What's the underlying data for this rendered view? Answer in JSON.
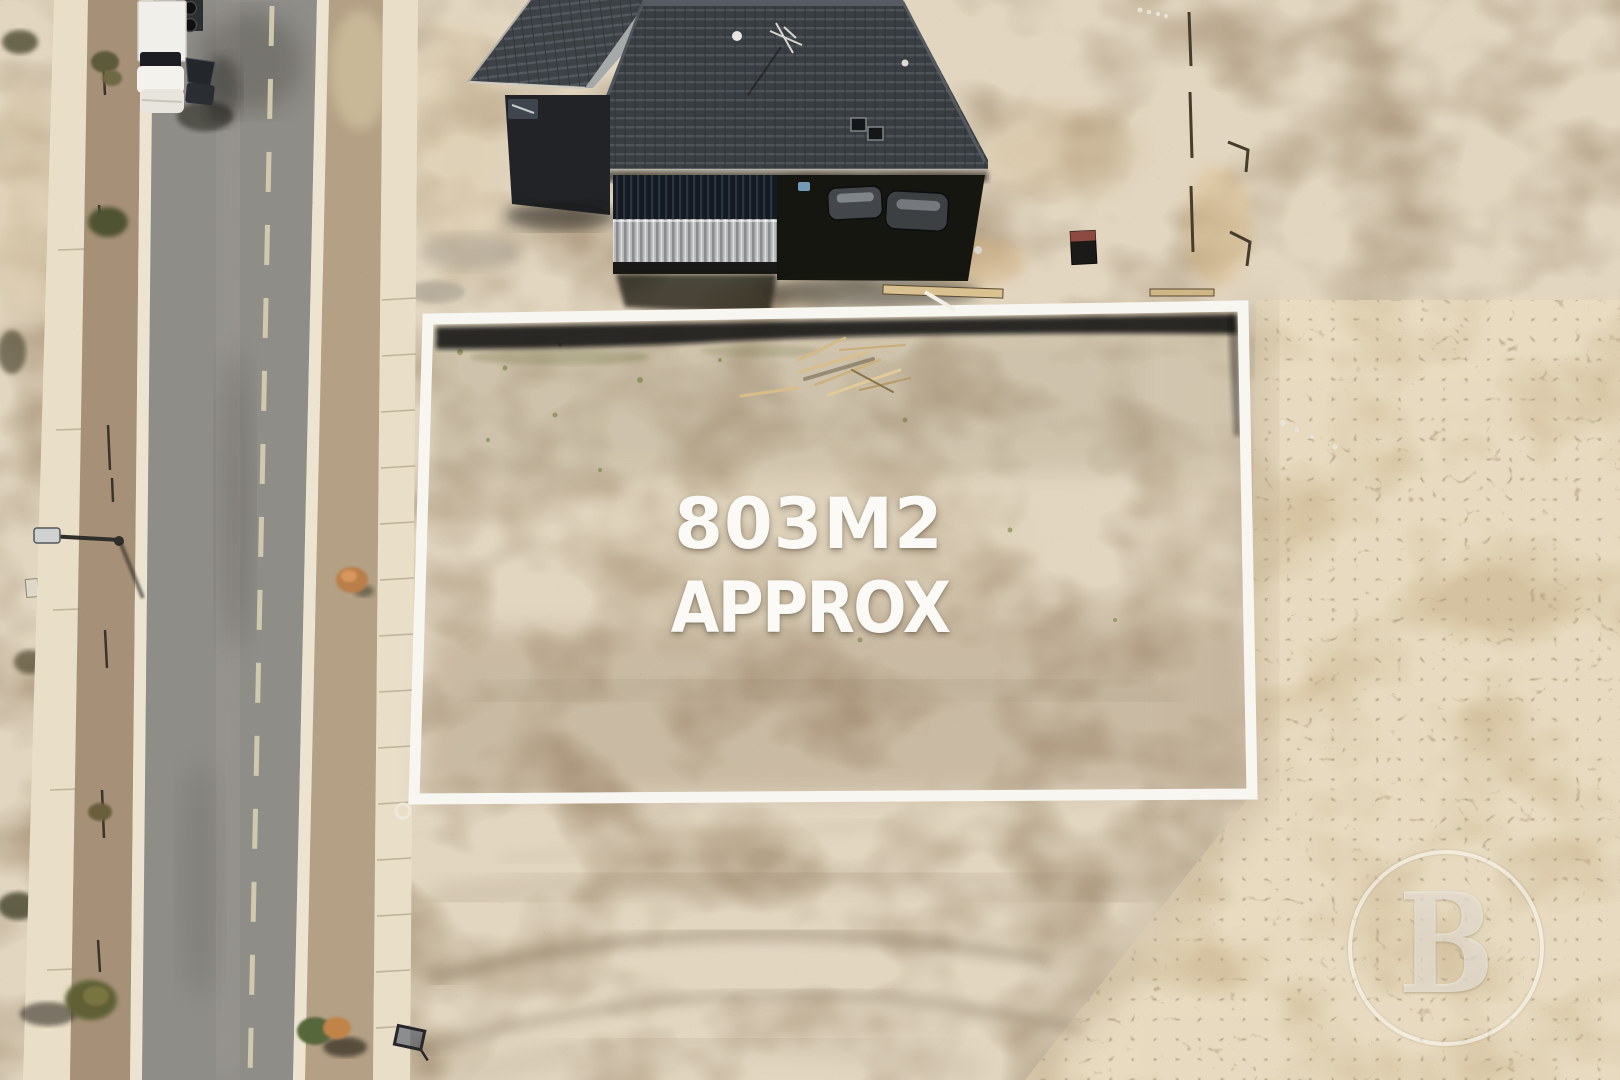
{
  "scene": {
    "description": "Aerial drone photograph of a vacant residential land lot marked with a white boundary outline, next to a road with a parked white van and a house with a dark tiled hip roof under construction",
    "lot_area_m2": 803
  },
  "overlay_text": {
    "line1": "803M2",
    "line2": "APPROX"
  },
  "watermark": {
    "letter": "B",
    "shape": "circle-outline"
  },
  "palette": {
    "dirt_base": "#b4a288",
    "dirt_light": "#dccbab",
    "dirt_dark": "#8a775c",
    "cracked_base": "#d8c6a3",
    "crack_line": "#7c6849",
    "road_asphalt": "#8f8d88",
    "road_dash": "#d6cfb2",
    "path_concrete": "#e9dfc8",
    "curb_concrete": "#ece4d0",
    "roof_dark": "#393e43",
    "roof_line": "#4d5357",
    "boundary_white": "#f8f6f0",
    "text_white": "#fbfaf6",
    "shadow_black": "#0c0b09",
    "van_white": "#f1efe9"
  }
}
